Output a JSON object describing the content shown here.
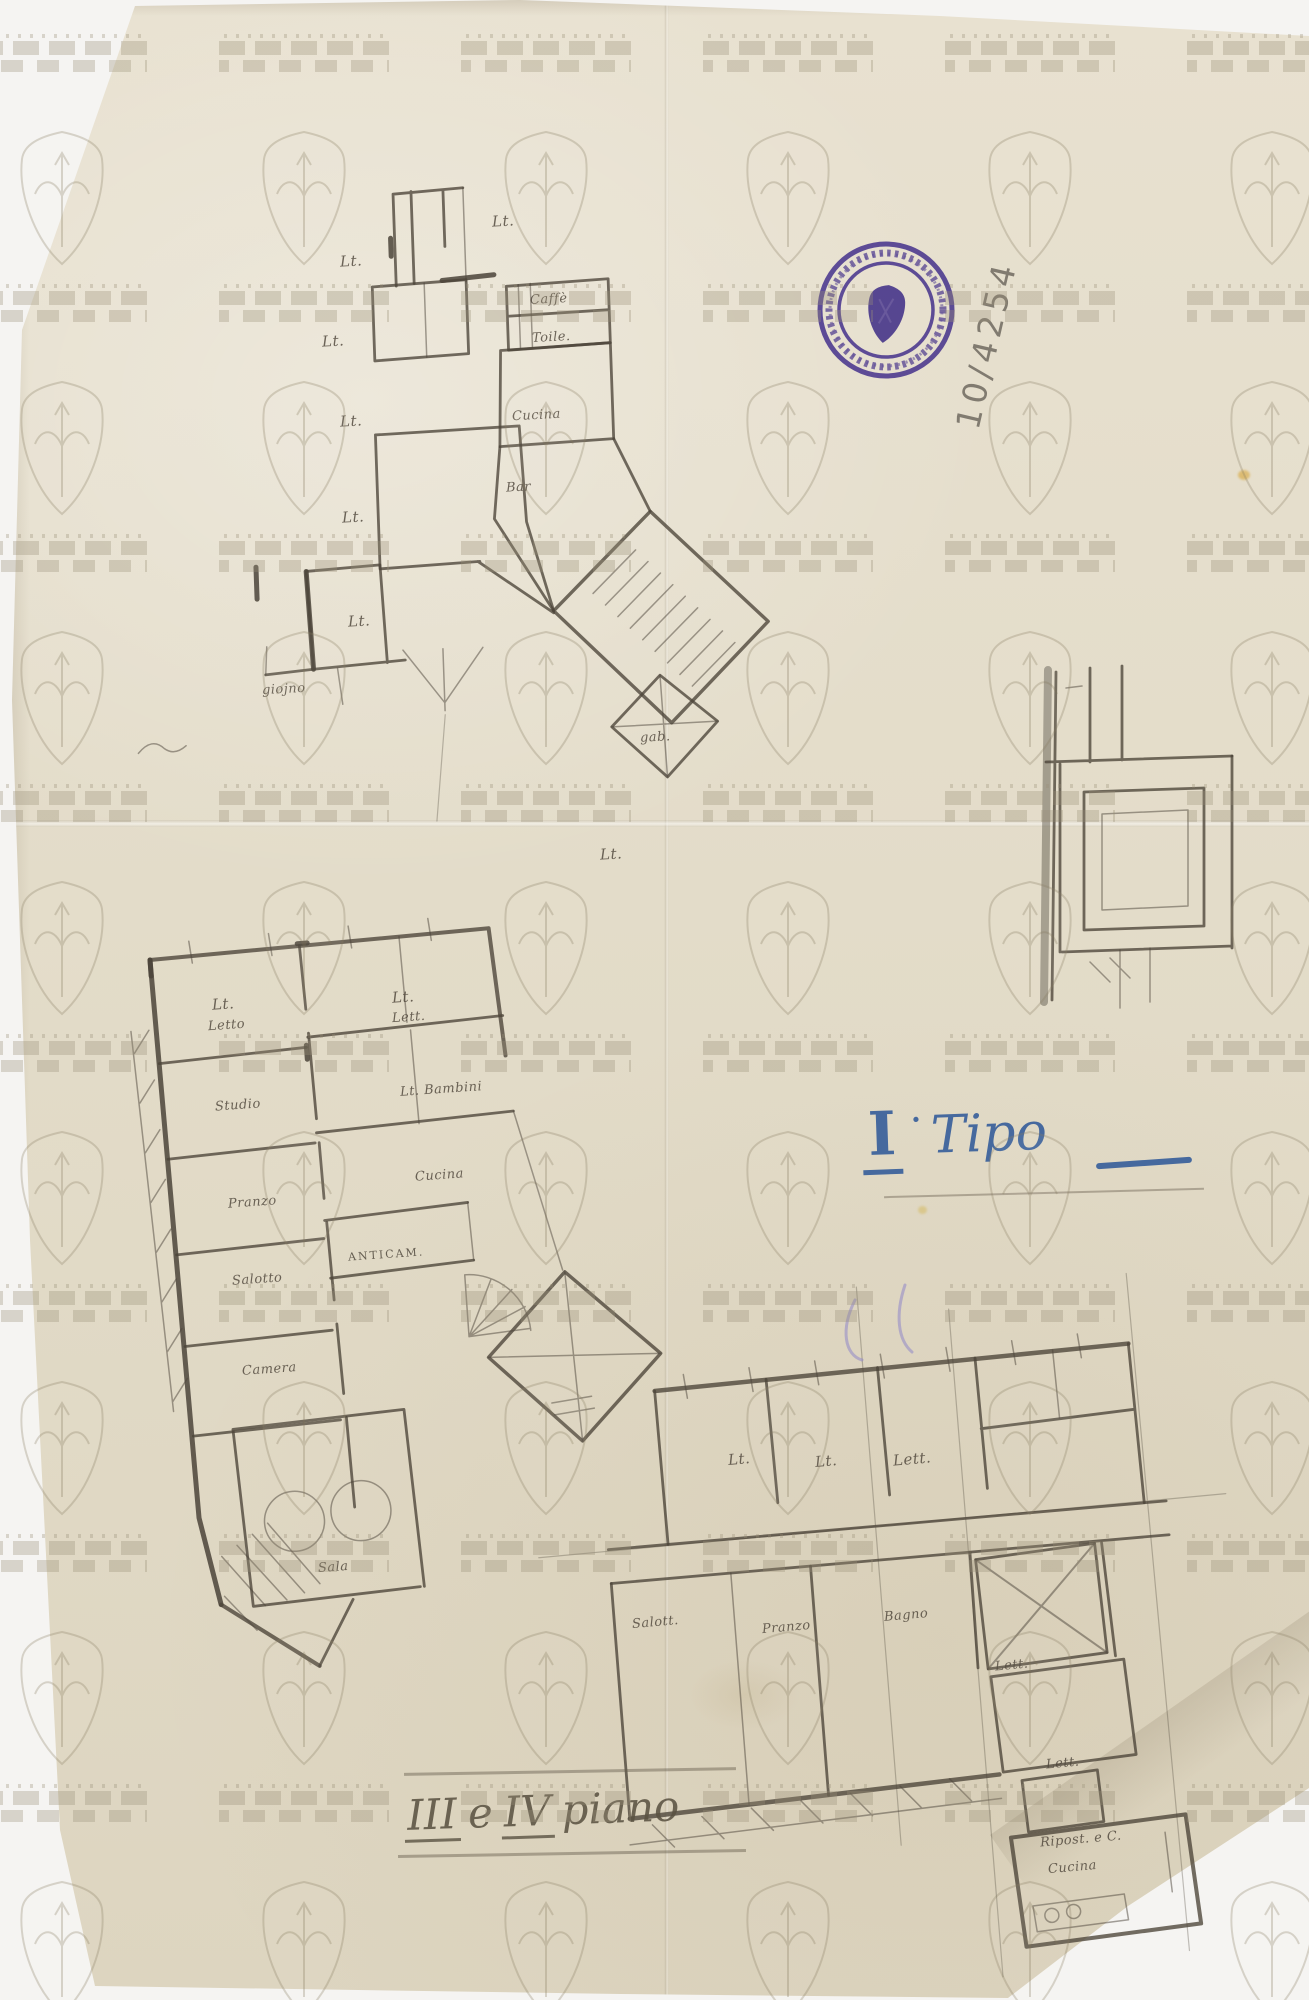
{
  "sheet": {
    "archive_number": "10/4254",
    "type_note": {
      "numeral": "I",
      "separator": "·",
      "word": "Tipo"
    },
    "caption": {
      "roman_a": "III",
      "conj": "e",
      "roman_b": "IV",
      "word": "piano"
    }
  },
  "stamp": {
    "shape": "circular",
    "ring_text": "illegible circular lettering",
    "emblem": "shield with halberd",
    "ink_color": "#5a47b2"
  },
  "watermark": {
    "motifs": [
      "castle-battlement-band",
      "shield-with-halberd"
    ],
    "repeat": "grid"
  },
  "plans": {
    "upper": {
      "labels": [
        "Lt.",
        "Lt.",
        "Lt.",
        "Lt.",
        "Lt.",
        "Lt.",
        "Lt.",
        "Caffè",
        "Toile.",
        "Cucina",
        "Bar",
        "gab.",
        "giojno"
      ]
    },
    "lower_left": {
      "labels": [
        "Lt.",
        "Letto",
        "Lt.",
        "Lett.",
        "Studio",
        "Lt. Bambini",
        "Pranzo",
        "Cucina",
        "Salotto",
        "ANTICAM.",
        "Camera",
        "Sala"
      ]
    },
    "right_wing": {
      "labels": [
        "Lt.",
        "Lt.",
        "Lett.",
        "Salott.",
        "Pranzo",
        "Bagno",
        "Lett.",
        "Lett.",
        "Ripost. e C.",
        "Cucina"
      ]
    }
  },
  "colors": {
    "margin": "#f5f4f2",
    "paper": "#e3dcc9",
    "pencil": "#4b4439",
    "stamp": "#5a47b2",
    "ink": "#46699e",
    "watermark": "#9a9078"
  }
}
